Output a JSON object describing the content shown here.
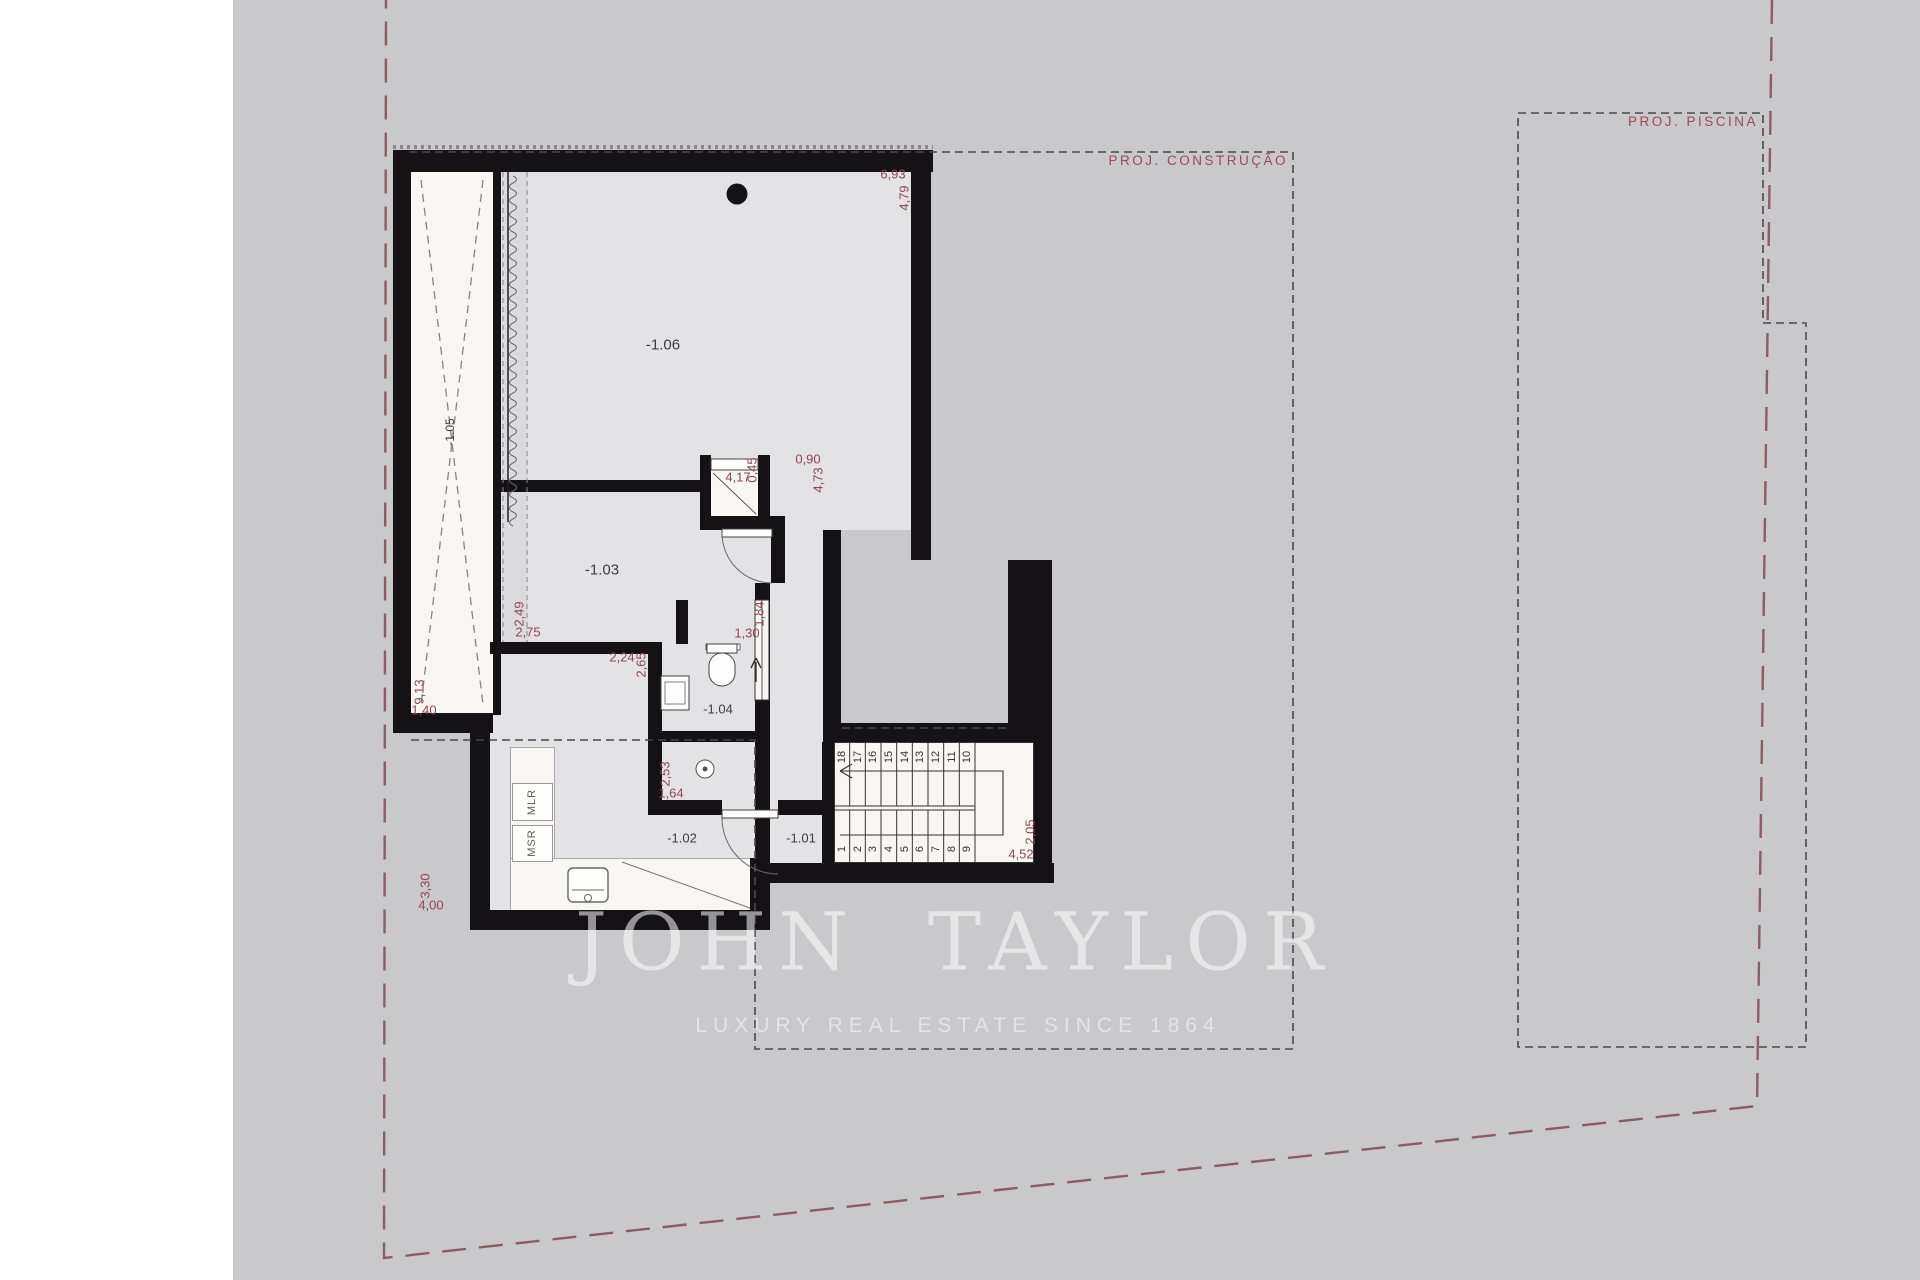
{
  "plan": {
    "construction_label": "PROJ. CONSTRUÇÃO",
    "pool_label": "PROJ. PISCINA",
    "room_labels": {
      "r101": "-1.01",
      "r102": "-1.02",
      "r103": "-1.03",
      "r104": "-1.04",
      "r105": "-1.05",
      "r106": "-1.06"
    },
    "appliance_labels": {
      "mlr": "MLR",
      "msr": "MSR"
    },
    "dimensions": {
      "d_693": "6,93",
      "d_479": "4,79",
      "d_417": "4,17",
      "d_045": "0,45",
      "d_090": "0,90",
      "d_473": "4,73",
      "d_249": "2,49",
      "d_275": "2,75",
      "d_224": "2,24",
      "d_265": "2,65",
      "d_184": "1,84",
      "d_130": "1,30",
      "d_913": "9,13",
      "d_140": "1,40",
      "d_253": "2,53",
      "d_164": "1,64",
      "d_330": "3,30",
      "d_400": "4,00",
      "d_205": "2,05",
      "d_452": "4,52"
    },
    "stair_steps_lower": [
      "1",
      "2",
      "3",
      "4",
      "5",
      "6",
      "7",
      "8",
      "9"
    ],
    "stair_steps_upper": [
      "18",
      "17",
      "16",
      "15",
      "14",
      "13",
      "12",
      "11",
      "10"
    ]
  },
  "watermark": {
    "title": "JOHN TAYLOR",
    "subtitle": "LUXURY REAL ESTATE SINCE 1864"
  },
  "colors": {
    "wall": "#141215",
    "sheet": "#c9c8ca",
    "room_fill": "#e3e2e4",
    "light_fill": "#f7f6f3",
    "dimension_text": "#8e4852",
    "projection_text": "#9a4b55"
  }
}
